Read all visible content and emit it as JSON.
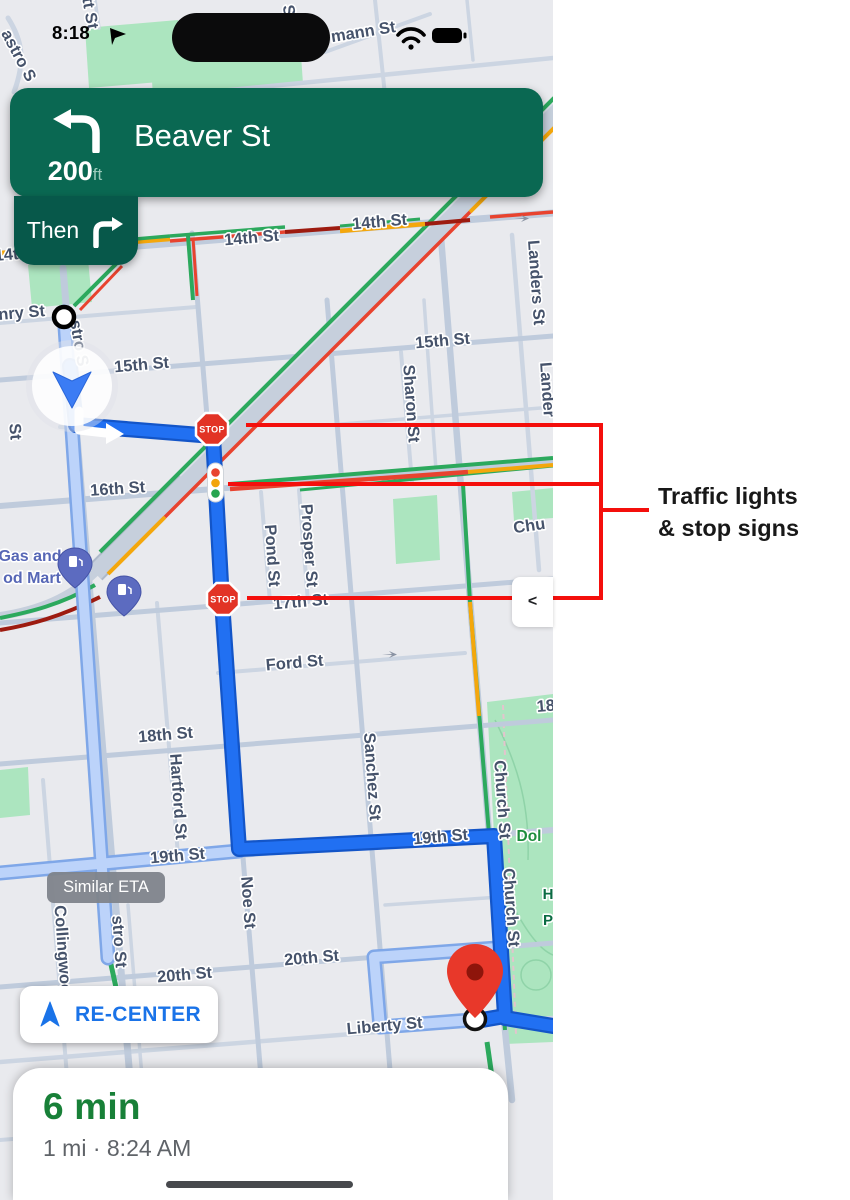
{
  "status_bar": {
    "time": "8:18"
  },
  "navigation_banner": {
    "distance_value": "200",
    "distance_unit": "ft",
    "instruction": "Beaver St",
    "then_label": "Then"
  },
  "map": {
    "stop_sign_label": "STOP",
    "similar_eta_label": "Similar ETA",
    "recenter_label": "RE-CENTER",
    "collapse_chevron": "<",
    "labels": [
      {
        "t": "14th St",
        "x": 252,
        "y": 243,
        "r": -5
      },
      {
        "t": "14th St",
        "x": 380,
        "y": 227,
        "r": -5
      },
      {
        "t": "15th St",
        "x": 142,
        "y": 370,
        "r": -5
      },
      {
        "t": "15th St",
        "x": 443,
        "y": 346,
        "r": -5
      },
      {
        "t": "16th St",
        "x": 118,
        "y": 494,
        "r": -4
      },
      {
        "t": "17th St",
        "x": 301,
        "y": 607,
        "r": -5
      },
      {
        "t": "Ford St",
        "x": 295,
        "y": 668,
        "r": -5
      },
      {
        "t": "18th St",
        "x": 166,
        "y": 740,
        "r": -5
      },
      {
        "t": "18t",
        "x": 549,
        "y": 711,
        "r": -5
      },
      {
        "t": "19th St",
        "x": 178,
        "y": 861,
        "r": -5
      },
      {
        "t": "19th St",
        "x": 441,
        "y": 842,
        "r": -5
      },
      {
        "t": "20th St",
        "x": 185,
        "y": 980,
        "r": -5
      },
      {
        "t": "20th St",
        "x": 312,
        "y": 963,
        "r": -5
      },
      {
        "t": "Liberty St",
        "x": 385,
        "y": 1031,
        "r": -5
      },
      {
        "t": "nry St",
        "x": 22,
        "y": 318,
        "r": -5
      },
      {
        "t": "14t",
        "x": 7,
        "y": 260,
        "r": -5
      },
      {
        "t": "Sharon St",
        "x": 406,
        "y": 404,
        "r": 86
      },
      {
        "t": "Landers St",
        "x": 531,
        "y": 283,
        "r": 86
      },
      {
        "t": "Lander",
        "x": 542,
        "y": 390,
        "r": 86
      },
      {
        "t": "Church St",
        "x": 497,
        "y": 800,
        "r": 86
      },
      {
        "t": "Church St",
        "x": 506,
        "y": 908,
        "r": 86
      },
      {
        "t": "Sanchez St",
        "x": 367,
        "y": 777,
        "r": 86
      },
      {
        "t": "Hartford St",
        "x": 173,
        "y": 797,
        "r": 86
      },
      {
        "t": "Collingwood",
        "x": 58,
        "y": 955,
        "r": 86
      },
      {
        "t": "Noe St",
        "x": 243,
        "y": 903,
        "r": 86
      },
      {
        "t": "stro St",
        "x": 114,
        "y": 942,
        "r": 86
      },
      {
        "t": "stro S",
        "x": 74,
        "y": 344,
        "r": 80
      },
      {
        "t": "Pond St",
        "x": 267,
        "y": 556,
        "r": 86
      },
      {
        "t": "Prosper St",
        "x": 304,
        "y": 546,
        "r": 86
      },
      {
        "t": "St",
        "x": 10,
        "y": 432,
        "r": 86
      },
      {
        "t": "tt St",
        "x": 85,
        "y": 14,
        "r": 80
      },
      {
        "t": "St",
        "x": 284,
        "y": 14,
        "r": 80
      },
      {
        "t": "astro S",
        "x": 14,
        "y": 58,
        "r": 62
      },
      {
        "t": "mann St",
        "x": 364,
        "y": 37,
        "r": -9
      },
      {
        "t": "Chu",
        "x": 530,
        "y": 531,
        "r": -8
      },
      {
        "t": "Gas and",
        "x": 30,
        "y": 561,
        "c": "poi"
      },
      {
        "t": "od Mart",
        "x": 32,
        "y": 583,
        "c": "poi"
      },
      {
        "t": "Dol",
        "x": 529,
        "y": 841,
        "c": "park"
      },
      {
        "t": "H",
        "x": 548,
        "y": 899,
        "c": "parkdark"
      },
      {
        "t": "P",
        "x": 548,
        "y": 925,
        "c": "parkdark"
      }
    ]
  },
  "annotation": {
    "line1": "Traffic lights",
    "line2": "& stop signs"
  },
  "eta_card": {
    "duration": "6 min",
    "details": "1 mi · 8:24 AM"
  },
  "colors": {
    "banner_green": "#0a6852",
    "then_green": "#07584a",
    "route_blue": "#2170f2",
    "alt_route_blue": "#bcd3fa",
    "traffic_green": "#2ca95d",
    "traffic_yellow": "#f4a70c",
    "traffic_red": "#e8432f",
    "traffic_dark_red": "#9d1b10",
    "annotation_red": "#f40f0c",
    "eta_green": "#188038",
    "recenter_blue": "#1a73e8"
  },
  "icons": [
    "left-turn-arrow",
    "right-turn-arrow",
    "navigation-puck",
    "stop-sign",
    "traffic-light",
    "gas-pump-pin",
    "destination-pin",
    "transit-stop-dot",
    "recenter-arrow",
    "wifi-icon",
    "battery-icon",
    "location-arrow",
    "home-indicator",
    "collapse-chevron"
  ]
}
